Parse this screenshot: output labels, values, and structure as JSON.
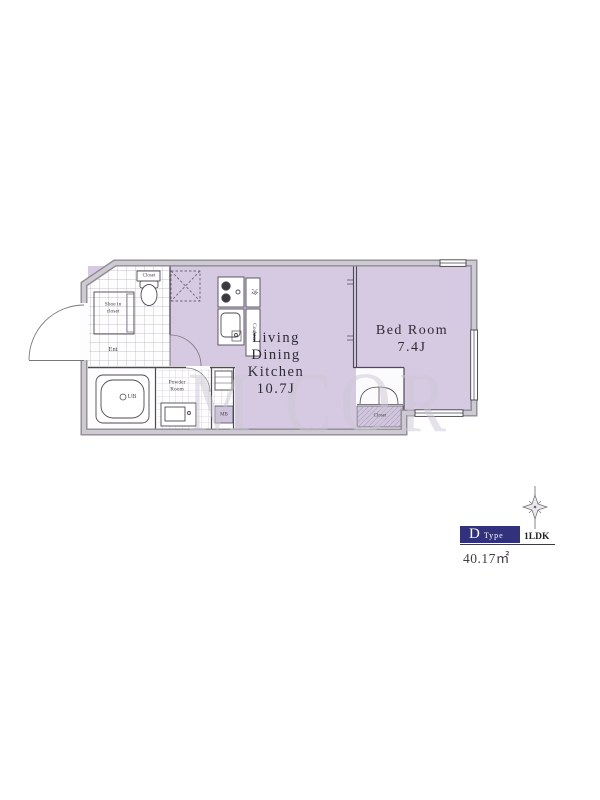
{
  "floor_plan": {
    "ldk": {
      "line1": "Living",
      "line2": "Dining",
      "line3": "Kitchen",
      "size": "10.7J"
    },
    "bedroom": {
      "name": "Bed Room",
      "size": "7.4J"
    },
    "labels": {
      "entrance": "Ent",
      "unit_bath": "UB",
      "powder_line1": "Powder",
      "powder_line2": "Room",
      "shoe_line1": "Shoe in",
      "shoe_line2": "closet",
      "toilet_shelf": "Closet",
      "bedroom_closet": "Closet",
      "counter": "Counter",
      "refrigerator": "冷",
      "meter_box": "MB"
    },
    "icons": {
      "compass": "compass-north-icon",
      "washer": "washing-machine-area-icon",
      "toilet": "toilet-icon",
      "bathtub": "bathtub-icon",
      "stove": "stove-icon",
      "kitchen_sink": "kitchen-sink-icon",
      "vanity": "vanity-sink-icon",
      "closet_doors": "closet-bifold-doors-icon"
    },
    "watermark": "M COR"
  },
  "legend": {
    "type_letter": "D",
    "type_word": "Type",
    "layout": "1LDK",
    "area": "40.17㎡"
  },
  "colors": {
    "room_fill": "#d6cae2",
    "closet_fill": "#d2c6df",
    "wall_gray": "#8e8b93",
    "wall_light": "#cdcbd1",
    "accent_navy": "#31317d",
    "text": "#2f2b36"
  }
}
